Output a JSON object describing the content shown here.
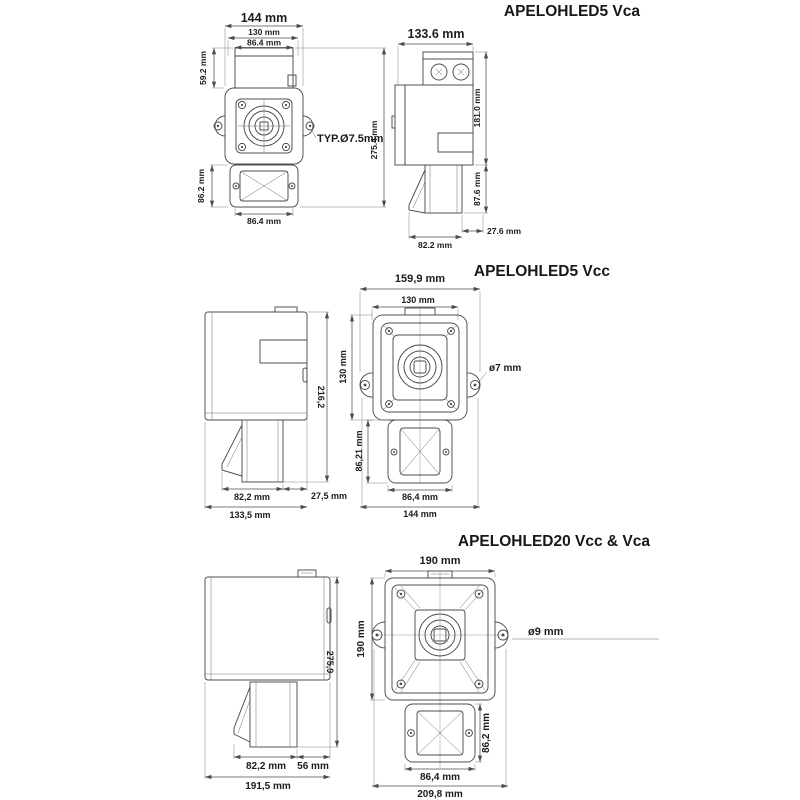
{
  "page": {
    "background": "#ffffff",
    "line_color": "#4c4c4c",
    "text_color": "#1c1c1c"
  },
  "diagrams": [
    {
      "title": "APELOHLED5 Vca",
      "front": {
        "w_overall": "144 mm",
        "w_holes": "130 mm",
        "w_box": "86.4 mm",
        "h_box": "59.2 mm",
        "h_sounder": "86.2 mm",
        "w_sounder": "86.4 mm",
        "h_total": "275.4 mm",
        "hole_callout": "TYP.Ø7.5mm"
      },
      "side": {
        "w": "133.6 mm",
        "h_body": "181.0 mm",
        "h_sounder": "87.6 mm",
        "offset": "27.6 mm",
        "depth": "82.2 mm"
      }
    },
    {
      "title": "APELOHLED5 Vcc",
      "side": {
        "h": "216,2",
        "depth": "82,2 mm",
        "w": "133,5 mm",
        "offset": "27,5 mm"
      },
      "front": {
        "w_overall": "159,9 mm",
        "w_holes": "130 mm",
        "h_beacon": "130 mm",
        "h_sounder": "86,21 mm",
        "w_sounder": "86,4 mm",
        "w_base": "144 mm",
        "hole_callout": "ø7 mm"
      }
    },
    {
      "title": "APELOHLED20 Vcc & Vca",
      "side": {
        "h": "275,9",
        "depth": "82,2 mm",
        "offset": "56 mm",
        "w": "191,5 mm"
      },
      "front": {
        "w_top": "190 mm",
        "h_beacon": "190 mm",
        "h_sounder": "86,2 mm",
        "w_sounder": "86,4 mm",
        "w_overall": "209,8 mm",
        "hole_callout": "ø9 mm"
      }
    }
  ]
}
